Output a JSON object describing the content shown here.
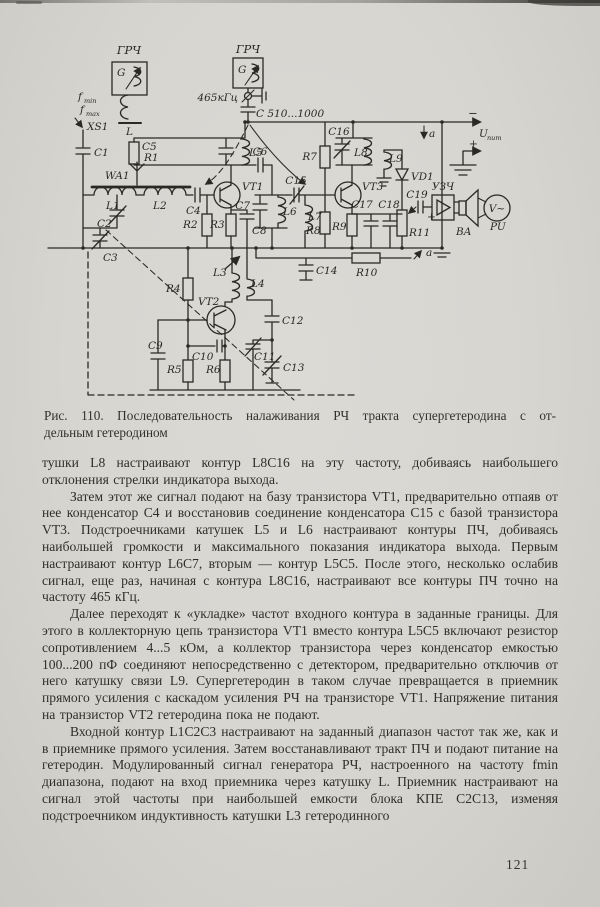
{
  "page": {
    "number": "121"
  },
  "figure": {
    "caption_line1": "Рис. 110. Последовательность налаживания РЧ тракта супергетеродина с от-",
    "caption_line2": "дельным гетеродином"
  },
  "schematic": {
    "labels": {
      "gen_left_title": "ГРЧ",
      "gen_left_g": "G",
      "gen_left_coil": "L",
      "f_min": "f",
      "f_min_sub": "min",
      "f_max": "f",
      "f_max_sub": "max",
      "xs1": "XS1",
      "c1": "C1",
      "wa1": "WA1",
      "l1": "L1",
      "l2": "L2",
      "c2": "C2",
      "c3": "C3",
      "c4": "C4",
      "r2": "R2",
      "r3": "R3",
      "vt1": "VT1",
      "c5": "C5",
      "r1": "R1",
      "l5": "L5",
      "c6": "C6",
      "c7": "C7",
      "l6": "L6",
      "c8": "C8",
      "gen_right_title": "ГРЧ",
      "gen_right_g": "G",
      "freq_465": "465кГц",
      "c_510": "С 510...1000",
      "r7": "R7",
      "c15": "C15",
      "l7": "L7",
      "r8": "R8",
      "vt3": "VT3",
      "c16": "C16",
      "l8": "L8",
      "l9": "L9",
      "vd1": "VD1",
      "c17": "C17",
      "c18": "C18",
      "r9": "R9",
      "r11": "R11",
      "c19": "C19",
      "c19_plus": "+",
      "uzch": "УЗЧ",
      "ba": "BA",
      "pu": "PU",
      "v_meter": "V~",
      "u_minus": "−",
      "u_plus": "+",
      "u_label": "U",
      "u_label_sub": "пит",
      "a_top": "a",
      "a_bottom": "a",
      "r4": "R4",
      "l3": "L3",
      "l4": "L4",
      "vt2": "VT2",
      "c9": "C9",
      "c10": "C10",
      "r5": "R5",
      "r6": "R6",
      "c11": "C11",
      "c12": "C12",
      "c13": "C13",
      "c14": "C14",
      "r10": "R10"
    }
  },
  "body": {
    "paragraphs": [
      "тушки L8 настраивают контур L8C16 на эту частоту, добиваясь наибольшего отклонения стрелки индикатора выхода.",
      "Затем этот же сигнал подают на базу транзистора VT1, предварительно отпаяв от нее конденсатор C4 и восстановив соединение конденсатора C15 с базой транзистора VT3. Подстроечниками катушек L5 и L6 настраивают контуры ПЧ, добиваясь наибольшей громкости и максимального показания индикатора выхода. Первым настраивают контур L6C7, вторым — контур L5C5. После этого, несколько ослабив сигнал, еще раз, начиная с контура L8C16, настраивают все контуры ПЧ точно на частоту 465 кГц.",
      "Далее переходят к «укладке» частот входного контура в заданные границы. Для этого в коллекторную цепь транзистора VT1 вместо контура L5C5 включают резистор сопротивлением 4...5 кОм, а коллектор транзистора через конденсатор емкостью 100...200 пФ соединяют непосредственно с детектором, предварительно отключив от него катушку связи L9. Супергетеродин в таком случае превращается в приемник прямого усиления с каскадом усиления РЧ на транзисторе VT1. Напряжение питания на транзистор VT2 гетеродина пока не подают.",
      "Входной контур L1C2C3 настраивают на заданный диапазон частот так же, как и в приемнике прямого усиления. Затем восстанавливают тракт ПЧ и подают питание на гетеродин. Модулированный сигнал генератора РЧ, настроенного на частоту fmin диапазона, подают на вход приемника через катушку L. Приемник настраивают на сигнал этой частоты при наибольшей емкости блока КПЕ C2C13, изменяя подстроечником индуктивность катушки L3 гетеродинного"
    ]
  }
}
